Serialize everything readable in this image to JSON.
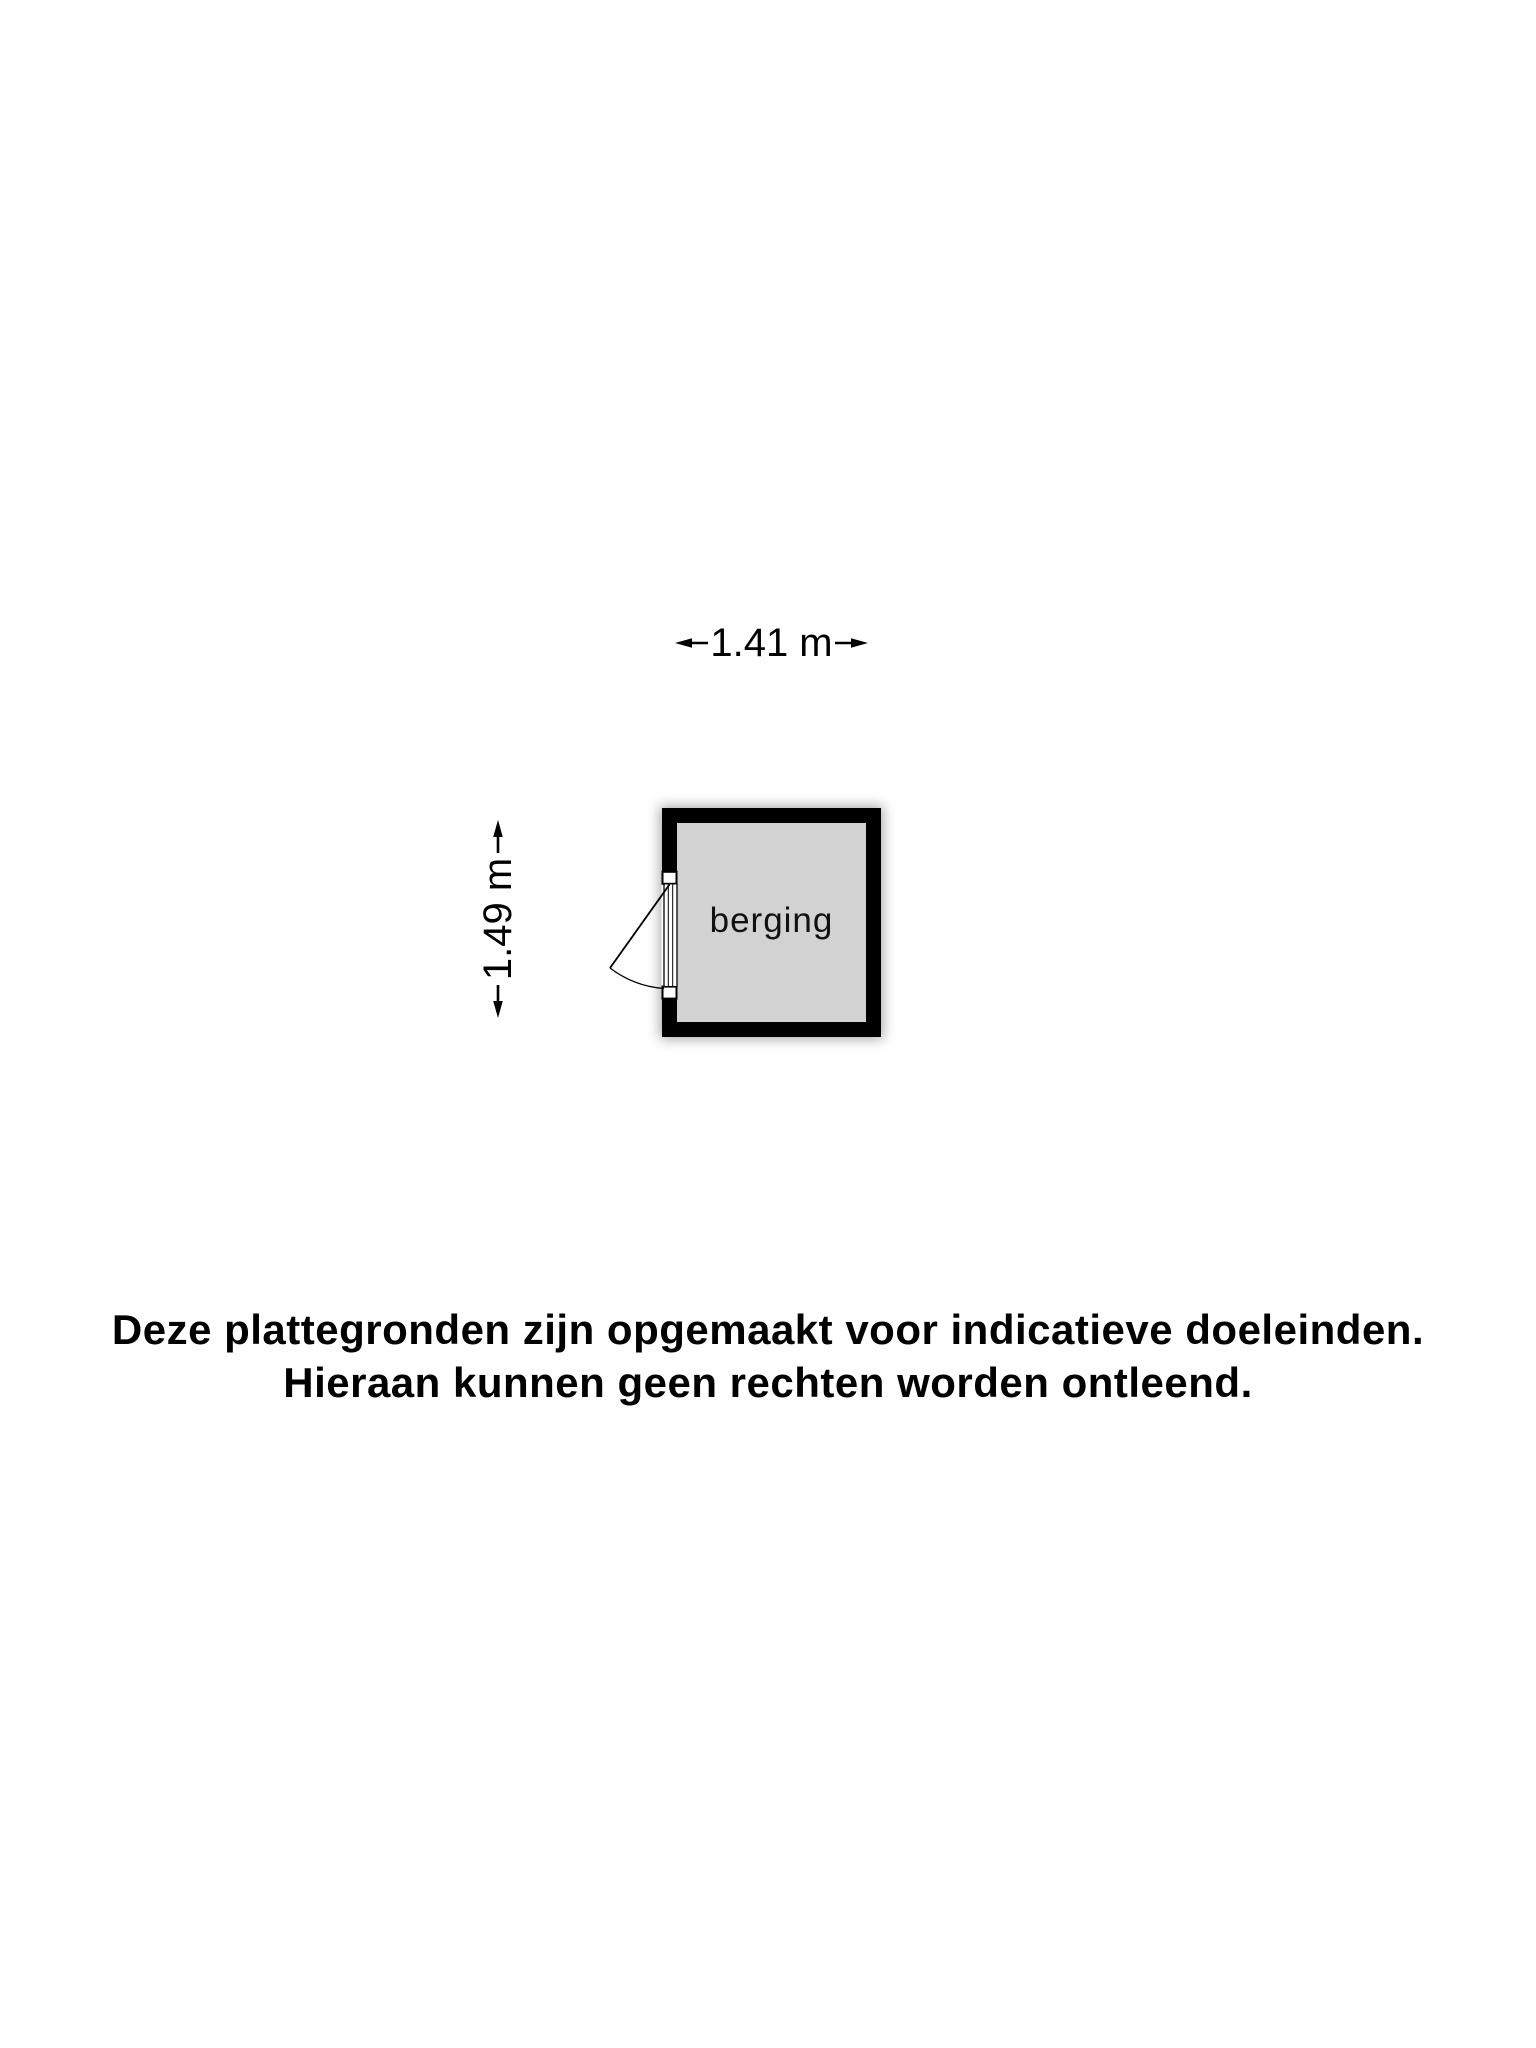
{
  "page": {
    "background_color": "#ffffff",
    "text_color": "#000000"
  },
  "floorplan": {
    "room": {
      "label": "berging",
      "wall_color": "#000000",
      "floor_color": "#d2d2d2"
    },
    "dimensions": {
      "width_label": "1.41 m",
      "height_label": "1.49 m"
    },
    "icons": {
      "width_arrows": [
        "dim-arrow-left-icon",
        "dim-arrow-right-icon"
      ],
      "height_arrows": [
        "dim-arrow-up-icon",
        "dim-arrow-down-icon"
      ],
      "door": "door-swing-icon"
    }
  },
  "disclaimer": {
    "line1": "Deze plattegronden zijn opgemaakt voor indicatieve doeleinden.",
    "line2": "Hieraan kunnen geen rechten worden ontleend."
  }
}
